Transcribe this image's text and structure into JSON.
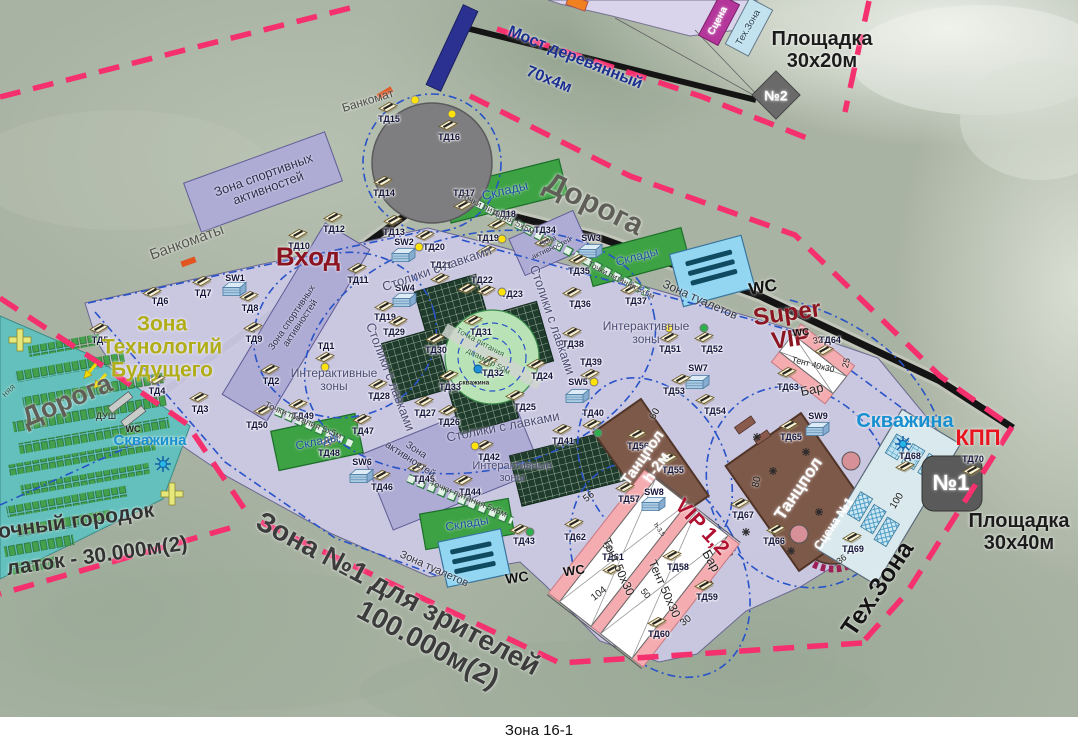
{
  "caption": "Зона 16-1",
  "colors": {
    "boundary_dash": "#f5306e",
    "road": "#141414",
    "venue_fill": "#cbc8e3",
    "camp_fill": "#63c0bc",
    "sports_zone_fill": "#aeabd4",
    "storage_green": "#3da244",
    "toilet_blue": "#92d6f2",
    "dance_brown": "#7d594a",
    "tent_pink": "#f4acb0",
    "accent_dark_red": "#8b1622",
    "kpp_red": "#e81420",
    "well_blue": "#1890d0",
    "tech_future_olive": "#b0ad18",
    "bridge_blue": "#2b3190",
    "inner_dash_blue": "#2853c8"
  },
  "icons": {
    "td_marker": "kiosk-icon",
    "sw_marker": "tech-cabinet-icon",
    "well": "sun-well-icon",
    "atm_point": "atm-tick-icon",
    "first_aid": "yellow-cross-icon",
    "entry": "yellow-arrow-icon",
    "toilet_block": "toilet-bars-icon",
    "stage_edge": "checker-arc-icon"
  },
  "map_labels": [
    {
      "t": "Мост деревянный",
      "x": 575,
      "y": 58,
      "r": 22,
      "s": 16,
      "c": "#1b2f8f",
      "w": 700,
      "n": "bridge-label"
    },
    {
      "t": "70х4м",
      "x": 549,
      "y": 80,
      "r": 22,
      "s": 16,
      "c": "#1b2f8f",
      "w": 700,
      "n": "bridge-size-label"
    },
    {
      "t": "Площадка\n30х20м",
      "x": 822,
      "y": 50,
      "r": 0,
      "s": 20,
      "c": "#1c1c1c",
      "w": 700,
      "n": "pad-30x20-label"
    },
    {
      "t": "Площадка\n30х40м",
      "x": 1019,
      "y": 532,
      "r": 0,
      "s": 20,
      "c": "#1c1c1c",
      "w": 700,
      "n": "pad-30x40-label"
    },
    {
      "t": "№2",
      "x": 776,
      "y": 96,
      "r": 0,
      "s": 14,
      "c": "#ffffff",
      "w": 700,
      "n": "pad2-number"
    },
    {
      "t": "№1",
      "x": 951,
      "y": 483,
      "r": 0,
      "s": 22,
      "c": "#ffffff",
      "w": 700,
      "n": "pad1-number"
    },
    {
      "t": "Дорога",
      "x": 67,
      "y": 401,
      "r": -23,
      "s": 27,
      "c": "#5f5f57",
      "w": 700,
      "n": "road-label-west"
    },
    {
      "t": "Дорога",
      "x": 594,
      "y": 204,
      "r": 26,
      "s": 30,
      "c": "#5f5f57",
      "w": 700,
      "n": "road-label-east"
    },
    {
      "t": "Банкоматы",
      "x": 187,
      "y": 243,
      "r": -20,
      "s": 15,
      "c": "#55554d",
      "w": 400,
      "n": "atms-label"
    },
    {
      "t": "Банкомат",
      "x": 368,
      "y": 101,
      "r": -17,
      "s": 12,
      "c": "#4a4a44",
      "w": 400,
      "n": "atm-label"
    },
    {
      "t": "Вход",
      "x": 308,
      "y": 257,
      "r": 0,
      "s": 26,
      "c": "#8b1420",
      "w": 700,
      "n": "entrance-label"
    },
    {
      "t": "Зона\nТехнологий\nБудущего",
      "x": 162,
      "y": 347,
      "r": 0,
      "s": 21,
      "c": "#b0ad18",
      "w": 700,
      "n": "future-tech-zone-label"
    },
    {
      "t": "Super\nVIP",
      "x": 789,
      "y": 327,
      "r": -8,
      "s": 24,
      "c": "#8b1622",
      "w": 700,
      "n": "super-vip-label"
    },
    {
      "t": "VIP 1,2",
      "x": 702,
      "y": 527,
      "r": 47,
      "s": 21,
      "c": "#b01030",
      "w": 700,
      "n": "vip12-label"
    },
    {
      "t": "КПП",
      "x": 978,
      "y": 438,
      "r": 0,
      "s": 22,
      "c": "#e81420",
      "w": 700,
      "n": "checkpoint-label"
    },
    {
      "t": "Скважина",
      "x": 150,
      "y": 441,
      "r": 0,
      "s": 15,
      "c": "#1890d0",
      "w": 700,
      "n": "well-label-west"
    },
    {
      "t": "Скважина",
      "x": 905,
      "y": 421,
      "r": 0,
      "s": 20,
      "c": "#1890d0",
      "w": 700,
      "n": "well-label-east"
    },
    {
      "t": "Тех.Зона",
      "x": 878,
      "y": 589,
      "r": -56,
      "s": 25,
      "c": "#141414",
      "w": 700,
      "n": "tech-zone-label"
    },
    {
      "t": "Зона №1 для зрителей",
      "x": 398,
      "y": 594,
      "r": 28,
      "s": 28,
      "c": "#3c3c3c",
      "w": 700,
      "n": "spectator-zone-label"
    },
    {
      "t": "100.000м(2)",
      "x": 428,
      "y": 645,
      "r": 28,
      "s": 28,
      "c": "#3c3c3c",
      "w": 700,
      "n": "spectator-zone-area"
    },
    {
      "t": "очный городок",
      "x": 76,
      "y": 521,
      "r": -8,
      "s": 21,
      "c": "#333333",
      "w": 700,
      "n": "tent-camp-label"
    },
    {
      "t": "латок - 30.000м(2)",
      "x": 97,
      "y": 556,
      "r": -8,
      "s": 21,
      "c": "#333333",
      "w": 700,
      "n": "tent-camp-area"
    },
    {
      "t": "Зона спортивных\nактивностей",
      "x": 266,
      "y": 182,
      "r": -20,
      "s": 13,
      "c": "#2c2c4e",
      "w": 400
    },
    {
      "t": "Зона спортивных\nактивностей",
      "x": 297,
      "y": 321,
      "r": -56,
      "s": 9.5,
      "c": "#2c2c4e",
      "w": 400
    },
    {
      "t": "Зона\nактивностей",
      "x": 550,
      "y": 245,
      "r": -25,
      "s": 7.5,
      "c": "#2c2c4e",
      "w": 400
    },
    {
      "t": "Зона\nактивностей",
      "x": 413,
      "y": 455,
      "r": 33,
      "s": 10,
      "c": "#2c2c4e",
      "w": 400
    },
    {
      "t": "Склады",
      "x": 505,
      "y": 191,
      "r": -14,
      "s": 13,
      "c": "#174f9e",
      "w": 400
    },
    {
      "t": "Склады",
      "x": 637,
      "y": 257,
      "r": -15,
      "s": 12,
      "c": "#174f9e",
      "w": 400
    },
    {
      "t": "Склады",
      "x": 317,
      "y": 442,
      "r": -12,
      "s": 12,
      "c": "#174f9e",
      "w": 400
    },
    {
      "t": "Склады",
      "x": 467,
      "y": 524,
      "r": -10,
      "s": 12,
      "c": "#174f9e",
      "w": 400
    },
    {
      "t": "Зона туалетов",
      "x": 700,
      "y": 300,
      "r": 24,
      "s": 12,
      "c": "#33333f",
      "w": 400
    },
    {
      "t": "Зона туалетов",
      "x": 434,
      "y": 569,
      "r": 24,
      "s": 11,
      "c": "#33333f",
      "w": 400
    },
    {
      "t": "WC",
      "x": 763,
      "y": 288,
      "r": -10,
      "s": 17,
      "c": "#111111",
      "w": 700
    },
    {
      "t": "WC",
      "x": 517,
      "y": 578,
      "r": -8,
      "s": 14,
      "c": "#111111",
      "w": 700
    },
    {
      "t": "WC",
      "x": 574,
      "y": 571,
      "r": -8,
      "s": 13,
      "c": "#111111",
      "w": 700
    },
    {
      "t": "WC",
      "x": 801,
      "y": 333,
      "r": -5,
      "s": 10,
      "c": "#111111",
      "w": 700
    },
    {
      "t": "WC",
      "x": 133,
      "y": 430,
      "r": 0,
      "s": 9,
      "c": "#222222",
      "w": 700
    },
    {
      "t": "ДУШ",
      "x": 106,
      "y": 417,
      "r": 0,
      "s": 9,
      "c": "#222222",
      "w": 400
    },
    {
      "t": "Столики с лавками",
      "x": 437,
      "y": 269,
      "r": -19,
      "s": 13,
      "c": "#4c4c74",
      "w": 400
    },
    {
      "t": "Столики с лавками",
      "x": 552,
      "y": 320,
      "r": 71,
      "s": 13,
      "c": "#4c4c74",
      "w": 400
    },
    {
      "t": "Столики с лавками",
      "x": 390,
      "y": 377,
      "r": 69,
      "s": 13,
      "c": "#4c4c74",
      "w": 400
    },
    {
      "t": "Столики с лавками",
      "x": 503,
      "y": 427,
      "r": -11,
      "s": 13,
      "c": "#4c4c74",
      "w": 400
    },
    {
      "t": "Интерактивные\nзоны",
      "x": 334,
      "y": 380,
      "r": 0,
      "s": 12,
      "c": "#4c4c74",
      "w": 400
    },
    {
      "t": "Интерактивные\nзоны",
      "x": 646,
      "y": 333,
      "r": 0,
      "s": 12,
      "c": "#4c4c74",
      "w": 400
    },
    {
      "t": "Интерактивные\nзоны",
      "x": 512,
      "y": 472,
      "r": 0,
      "s": 11,
      "c": "#4c4c74",
      "w": 400
    },
    {
      "t": "Точки питания 5х5м",
      "x": 497,
      "y": 214,
      "r": 27,
      "s": 9,
      "c": "#3c3c3c",
      "w": 400
    },
    {
      "t": "Точки питания 5х5м",
      "x": 621,
      "y": 281,
      "r": 27,
      "s": 8,
      "c": "#3c3c3c",
      "w": 400
    },
    {
      "t": "Точки питания 5х5м",
      "x": 303,
      "y": 421,
      "r": 23,
      "s": 9,
      "c": "#3c3c3c",
      "w": 400
    },
    {
      "t": "Точки питания 5х5м",
      "x": 468,
      "y": 499,
      "r": 23,
      "s": 9,
      "c": "#3c3c3c",
      "w": 400
    },
    {
      "t": "Точка питания",
      "x": 480,
      "y": 343,
      "r": 28,
      "s": 8,
      "c": "#2e6a3a",
      "w": 400
    },
    {
      "t": "диаметр 50м",
      "x": 488,
      "y": 362,
      "r": 28,
      "s": 8,
      "c": "#2e6a3a",
      "w": 400
    },
    {
      "t": "скважина",
      "x": 474,
      "y": 383,
      "r": 0,
      "s": 6.5,
      "c": "#222222",
      "w": 700
    },
    {
      "t": "Танцпол\nh-2м",
      "x": 650,
      "y": 463,
      "r": -55,
      "s": 15,
      "c": "#ffffff",
      "w": 700,
      "n": "dance-floor-small-label"
    },
    {
      "t": "Танцпол",
      "x": 799,
      "y": 489,
      "r": -56,
      "s": 17,
      "c": "#ffffff",
      "w": 700,
      "n": "dance-floor-big-label"
    },
    {
      "t": "Сцена №1",
      "x": 834,
      "y": 524,
      "r": -56,
      "s": 12,
      "c": "#ffffff",
      "w": 700,
      "n": "stage-label"
    },
    {
      "t": "Тент 40х30",
      "x": 813,
      "y": 365,
      "r": 14,
      "s": 8.5,
      "c": "#222222",
      "w": 400
    },
    {
      "t": "Тент 50х30",
      "x": 618,
      "y": 567,
      "r": 66,
      "s": 12,
      "c": "#222222",
      "w": 400
    },
    {
      "t": "Тент 50х30",
      "x": 664,
      "y": 589,
      "r": 66,
      "s": 12,
      "c": "#222222",
      "w": 400
    },
    {
      "t": "Бар",
      "x": 812,
      "y": 390,
      "r": -12,
      "s": 13,
      "c": "#222222",
      "w": 400
    },
    {
      "t": "Бар",
      "x": 711,
      "y": 561,
      "r": 60,
      "s": 13,
      "c": "#222222",
      "w": 400
    },
    {
      "t": "Сцена",
      "x": 718,
      "y": 21,
      "r": -62,
      "s": 10,
      "c": "#ffffff",
      "w": 700,
      "n": "north-stage-label"
    },
    {
      "t": "Тех.Зона",
      "x": 749,
      "y": 28,
      "r": -60,
      "s": 9.5,
      "c": "#1c3c50",
      "w": 400,
      "n": "north-tech-label"
    },
    {
      "t": "60",
      "x": 655,
      "y": 414,
      "r": -60,
      "s": 10,
      "c": "#1c1c1c",
      "w": 400
    },
    {
      "t": "80",
      "x": 757,
      "y": 482,
      "r": -77,
      "s": 10,
      "c": "#1c1c1c",
      "w": 400
    },
    {
      "t": "56",
      "x": 589,
      "y": 497,
      "r": -38,
      "s": 10,
      "c": "#1c1c1c",
      "w": 400
    },
    {
      "t": "50",
      "x": 607,
      "y": 548,
      "r": 52,
      "s": 9,
      "c": "#1c1c1c",
      "w": 400
    },
    {
      "t": "50",
      "x": 645,
      "y": 594,
      "r": 52,
      "s": 9,
      "c": "#1c1c1c",
      "w": 400
    },
    {
      "t": "30",
      "x": 686,
      "y": 621,
      "r": -38,
      "s": 10,
      "c": "#1c1c1c",
      "w": 400
    },
    {
      "t": "104",
      "x": 599,
      "y": 594,
      "r": -38,
      "s": 10,
      "c": "#1c1c1c",
      "w": 400
    },
    {
      "t": "32",
      "x": 818,
      "y": 341,
      "r": -10,
      "s": 9,
      "c": "#1c1c1c",
      "w": 400
    },
    {
      "t": "25",
      "x": 847,
      "y": 363,
      "r": -77,
      "s": 9,
      "c": "#1c1c1c",
      "w": 400
    },
    {
      "t": "100",
      "x": 897,
      "y": 501,
      "r": -58,
      "s": 10,
      "c": "#1c1c1c",
      "w": 400
    },
    {
      "t": "36",
      "x": 842,
      "y": 560,
      "r": -38,
      "s": 9,
      "c": "#1c1c1c",
      "w": 400
    },
    {
      "t": "h-3,5",
      "x": 659,
      "y": 530,
      "r": 55,
      "s": 6.5,
      "c": "#1c1c1c",
      "w": 400
    },
    {
      "t": "няя",
      "x": 9,
      "y": 391,
      "r": -42,
      "s": 9,
      "c": "#2c5c54",
      "w": 400
    }
  ],
  "markers": [
    {
      "id": "ТД1",
      "x": 325,
      "y": 356,
      "ly": -10,
      "dot": [
        0,
        11,
        "y"
      ]
    },
    {
      "id": "ТД2",
      "x": 270,
      "y": 368
    },
    {
      "id": "ТД3",
      "x": 199,
      "y": 396
    },
    {
      "id": "ТД4",
      "x": 156,
      "y": 378
    },
    {
      "id": "ТД5",
      "x": 99,
      "y": 327
    },
    {
      "id": "ТД6",
      "x": 152,
      "y": 291,
      "lx": 8,
      "ly": 10
    },
    {
      "id": "ТД7",
      "x": 202,
      "y": 280
    },
    {
      "id": "SW1",
      "x": 234,
      "y": 289,
      "ly": -11
    },
    {
      "id": "ТД8",
      "x": 249,
      "y": 295
    },
    {
      "id": "ТД9",
      "x": 253,
      "y": 326
    },
    {
      "id": "ТД10",
      "x": 298,
      "y": 233
    },
    {
      "id": "ТД11",
      "x": 357,
      "y": 267
    },
    {
      "id": "ТД12",
      "x": 333,
      "y": 216
    },
    {
      "id": "ТД13",
      "x": 393,
      "y": 219
    },
    {
      "id": "ТД14",
      "x": 383,
      "y": 180
    },
    {
      "id": "ТД15",
      "x": 388,
      "y": 106
    },
    {
      "id": "ТД16",
      "x": 448,
      "y": 124,
      "dot": [
        4,
        -10,
        "y"
      ]
    },
    {
      "id": "ТД17",
      "x": 463,
      "y": 204,
      "ly": -11
    },
    {
      "id": "ТД18",
      "x": 497,
      "y": 223,
      "lx": 8,
      "ly": -9
    },
    {
      "id": "ТД19",
      "x": 487,
      "y": 249,
      "ly": -11,
      "dot": [
        15,
        -10,
        "y"
      ]
    },
    {
      "id": "SW2",
      "x": 403,
      "y": 255,
      "ly": -13
    },
    {
      "id": "ТД20",
      "x": 425,
      "y": 234,
      "lx": 9,
      "dot": [
        -6,
        13,
        "y"
      ]
    },
    {
      "id": "ТД21",
      "x": 440,
      "y": 277,
      "ly": -12
    },
    {
      "id": "ТД22",
      "x": 467,
      "y": 287,
      "lx": 15,
      "ly": -7
    },
    {
      "id": "ТД23",
      "x": 486,
      "y": 289,
      "lx": 26,
      "ly": 5,
      "dot": [
        16,
        3,
        "y"
      ]
    },
    {
      "id": "SW4",
      "x": 404,
      "y": 300,
      "ly": -12
    },
    {
      "id": "ТД19",
      "x": 384,
      "y": 305,
      "ly": 12
    },
    {
      "id": "ТД29",
      "x": 398,
      "y": 320,
      "lx": -4,
      "ly": 12
    },
    {
      "id": "ТД30",
      "x": 435,
      "y": 337
    },
    {
      "id": "ТД31",
      "x": 473,
      "y": 319,
      "lx": 8
    },
    {
      "id": "ТД32",
      "x": 488,
      "y": 360,
      "lx": 5
    },
    {
      "id": "ТД33",
      "x": 449,
      "y": 374
    },
    {
      "id": "ТД24",
      "x": 536,
      "y": 363,
      "lx": 6
    },
    {
      "id": "ТД25",
      "x": 515,
      "y": 394,
      "lx": 10
    },
    {
      "id": "ТД26",
      "x": 448,
      "y": 409
    },
    {
      "id": "ТД27",
      "x": 424,
      "y": 400
    },
    {
      "id": "ТД28",
      "x": 378,
      "y": 383
    },
    {
      "id": "ТД34",
      "x": 544,
      "y": 241,
      "ly": -11
    },
    {
      "id": "SW3",
      "x": 590,
      "y": 251,
      "ly": -13
    },
    {
      "id": "ТД35",
      "x": 578,
      "y": 258
    },
    {
      "id": "ТД36",
      "x": 572,
      "y": 291,
      "lx": 8
    },
    {
      "id": "ТД37",
      "x": 630,
      "y": 288,
      "lx": 6
    },
    {
      "id": "ТД38",
      "x": 572,
      "y": 331
    },
    {
      "id": "ТД39",
      "x": 590,
      "y": 373,
      "ly": -11
    },
    {
      "id": "SW5",
      "x": 577,
      "y": 396,
      "ly": -14,
      "dot": [
        17,
        -14,
        "y"
      ]
    },
    {
      "id": "ТД40",
      "x": 592,
      "y": 423,
      "ly": -10,
      "dot": [
        6,
        10,
        "g"
      ]
    },
    {
      "id": "ТД41",
      "x": 562,
      "y": 428
    },
    {
      "id": "ТД42",
      "x": 484,
      "y": 444,
      "lx": 5,
      "dot": [
        -9,
        2,
        "y"
      ]
    },
    {
      "id": "ТД43",
      "x": 519,
      "y": 528,
      "lx": 5,
      "dot": [
        11,
        4,
        "g"
      ]
    },
    {
      "id": "ТД44",
      "x": 463,
      "y": 479,
      "lx": 7
    },
    {
      "id": "ТД45",
      "x": 417,
      "y": 466,
      "lx": 7
    },
    {
      "id": "ТД46",
      "x": 381,
      "y": 474
    },
    {
      "id": "ТД47",
      "x": 362,
      "y": 418
    },
    {
      "id": "ТД48",
      "x": 328,
      "y": 440
    },
    {
      "id": "ТД49",
      "x": 298,
      "y": 403,
      "lx": 5
    },
    {
      "id": "ТД50",
      "x": 263,
      "y": 409,
      "lx": -6,
      "ly": 16
    },
    {
      "id": "SW6",
      "x": 361,
      "y": 476,
      "ly": -14
    },
    {
      "id": "ТД51",
      "x": 669,
      "y": 336,
      "dot": [
        0,
        -8,
        "y"
      ]
    },
    {
      "id": "ТД52",
      "x": 704,
      "y": 336,
      "lx": 8,
      "dot": [
        0,
        -8,
        "g"
      ]
    },
    {
      "id": "SW7",
      "x": 697,
      "y": 382,
      "ly": -14
    },
    {
      "id": "ТД53",
      "x": 681,
      "y": 378,
      "lx": -7
    },
    {
      "id": "ТД54",
      "x": 705,
      "y": 398,
      "lx": 10
    },
    {
      "id": "ТД55",
      "x": 668,
      "y": 457,
      "lx": 5
    },
    {
      "id": "ТД56",
      "x": 637,
      "y": 433
    },
    {
      "id": "ТД57",
      "x": 625,
      "y": 486,
      "lx": 4
    },
    {
      "id": "SW8",
      "x": 653,
      "y": 504,
      "ly": -12
    },
    {
      "id": "ТД58",
      "x": 672,
      "y": 554,
      "lx": 6
    },
    {
      "id": "ТД59",
      "x": 704,
      "y": 584,
      "lx": 3
    },
    {
      "id": "ТД60",
      "x": 657,
      "y": 621,
      "lx": 2
    },
    {
      "id": "ТД61",
      "x": 612,
      "y": 568,
      "ly": -11
    },
    {
      "id": "ТД62",
      "x": 574,
      "y": 522,
      "ly": 15
    },
    {
      "id": "ТД63",
      "x": 787,
      "y": 371,
      "ly": 16
    },
    {
      "id": "ТД64",
      "x": 824,
      "y": 349,
      "lx": 6,
      "ly": -9
    },
    {
      "id": "SW9",
      "x": 817,
      "y": 429,
      "ly": -13
    },
    {
      "id": "ТД65",
      "x": 789,
      "y": 424,
      "lx": 2
    },
    {
      "id": "ТД66",
      "x": 776,
      "y": 528,
      "lx": -2
    },
    {
      "id": "ТД67",
      "x": 740,
      "y": 502,
      "lx": 3
    },
    {
      "id": "ТД68",
      "x": 905,
      "y": 465,
      "lx": 5,
      "ly": -9
    },
    {
      "id": "ТД69",
      "x": 852,
      "y": 536
    },
    {
      "id": "ТД70",
      "x": 972,
      "y": 469,
      "ly": -10
    }
  ]
}
